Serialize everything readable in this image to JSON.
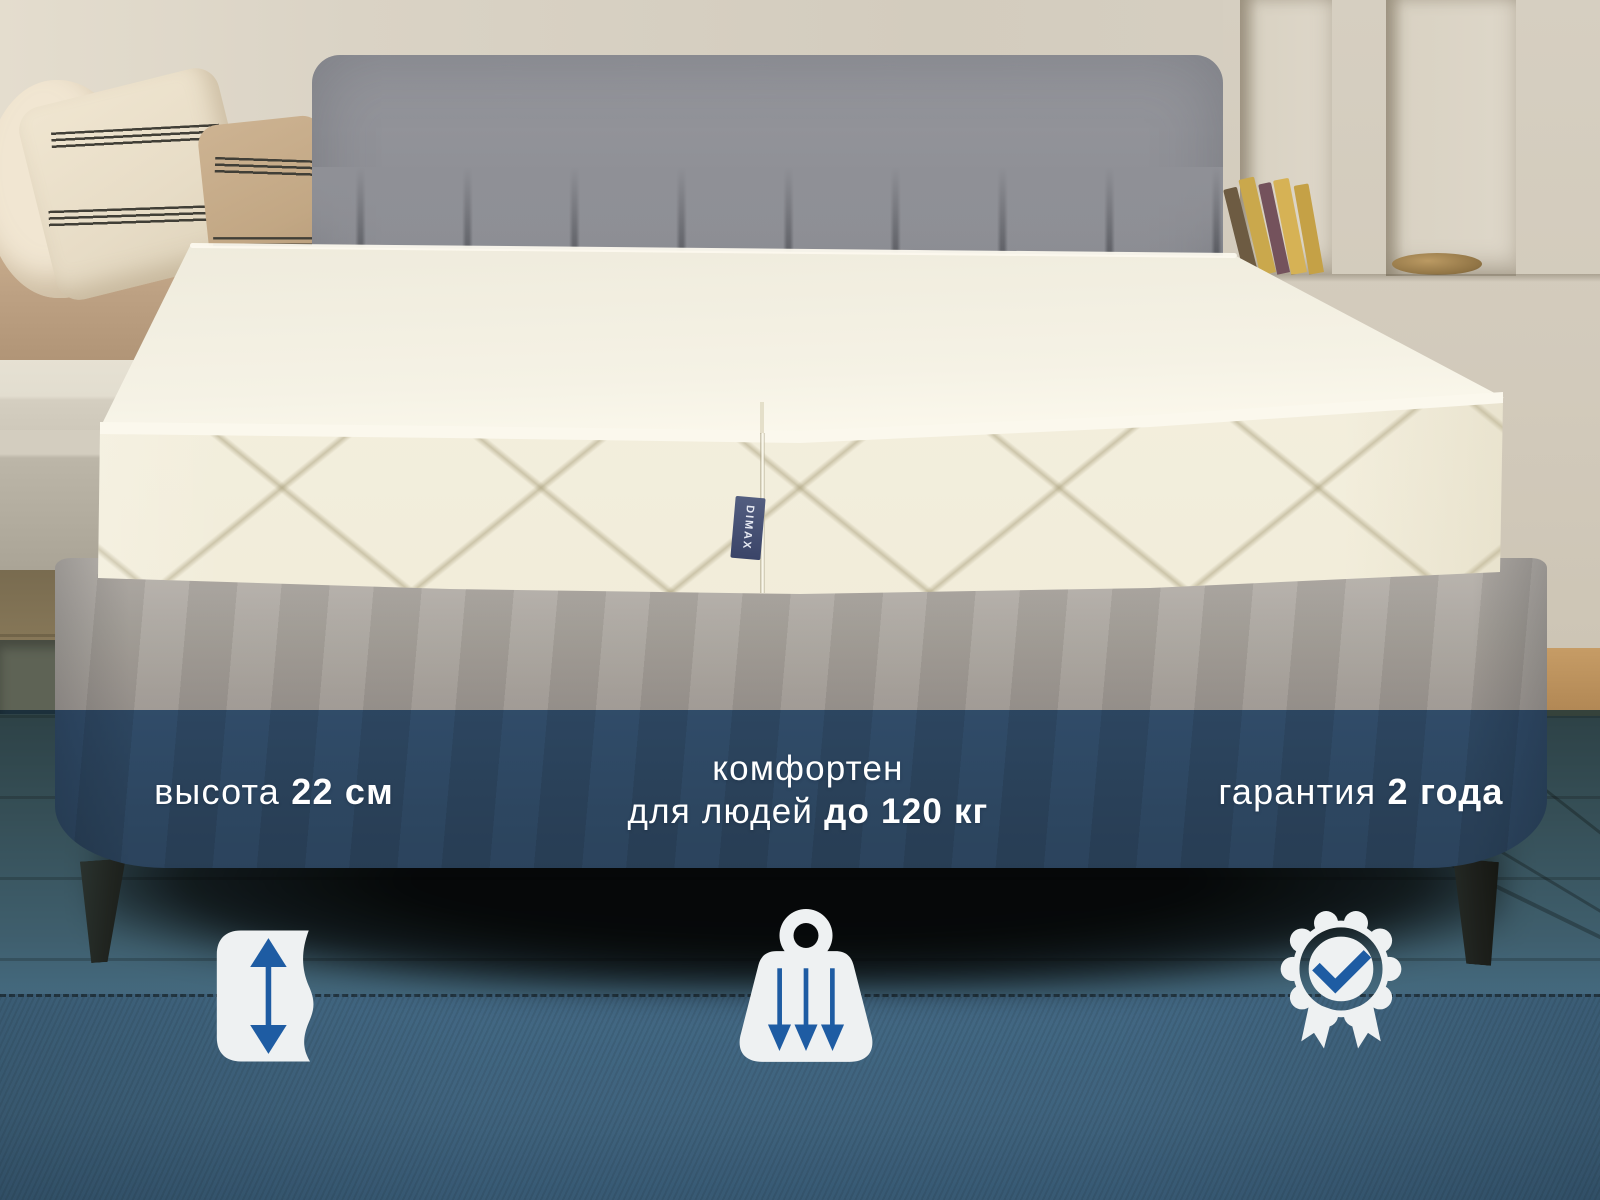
{
  "brand_tag": {
    "text": "DIMAX"
  },
  "captions": {
    "height": {
      "regular": "высота",
      "bold": "22 см"
    },
    "comfort": {
      "line1": "комфортен",
      "line2_regular": "для людей",
      "line2_bold": "до 120 кг"
    },
    "warranty": {
      "regular": "гарантия",
      "bold": "2 года"
    }
  },
  "icons": [
    {
      "name": "height-double-arrow-icon"
    },
    {
      "name": "weight-load-icon"
    },
    {
      "name": "warranty-badge-icon"
    }
  ],
  "colors": {
    "accent_blue": "#1e5ca3",
    "icon_white": "#eef1f2",
    "text_white": "#ffffff",
    "overlay_blue_result": "#33516f",
    "rug_blue_result": "#44678b",
    "mattress_white": "#f2eedd",
    "base_grey": "#a49e97",
    "headboard_grey": "#8b8d93",
    "leg_brown": "#7a573a"
  }
}
